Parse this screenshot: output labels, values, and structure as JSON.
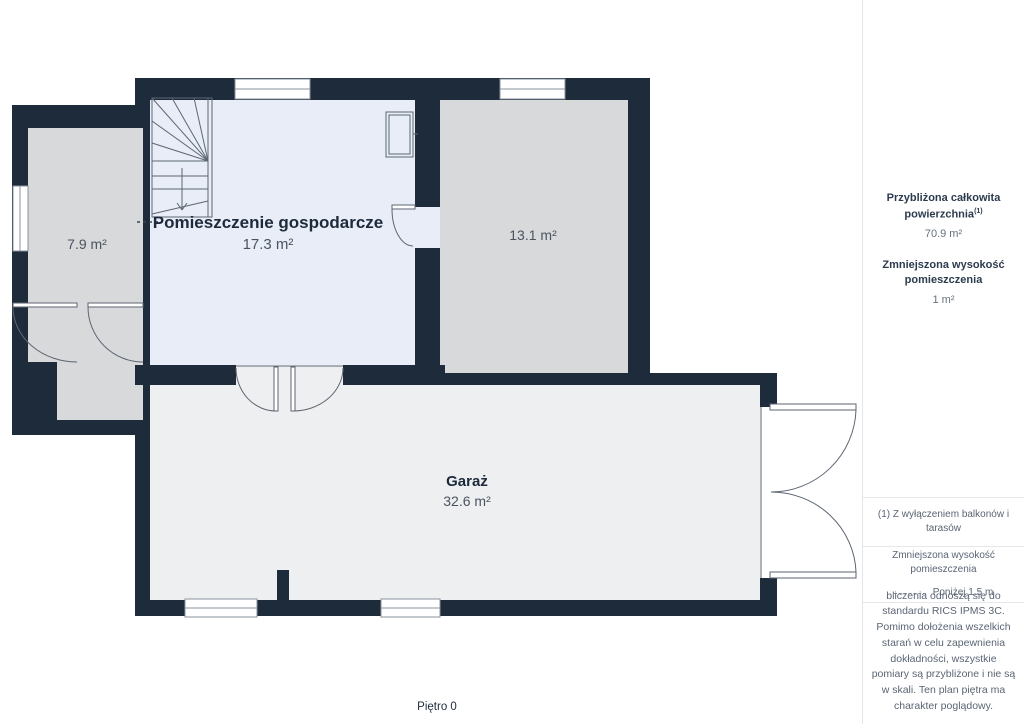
{
  "plan": {
    "rooms": {
      "utility": {
        "name": "Pomieszczenie gospodarcze",
        "area": "17.3 m²"
      },
      "room_13": {
        "area": "13.1 m²"
      },
      "room_79": {
        "area": "7.9 m²"
      },
      "garage": {
        "name": "Garaż",
        "area": "32.6 m²"
      }
    },
    "floor_label": "Piętro 0"
  },
  "sidebar": {
    "total_area_title": "Przybliżona całkowita powierzchnia",
    "total_area_footnote_marker": "(1)",
    "total_area_value": "70.9 m²",
    "reduced_height_title": "Zmniejszona wysokość pomieszczenia",
    "reduced_height_value": "1 m²",
    "footnote": "(1) Z wyłączeniem balkonów i tarasów",
    "legend_title": "Zmniejszona wysokość pomieszczenia",
    "legend_value": "Poniżej 1.5 m",
    "disclaimer": "bliczenia odnoszą się do standardu RICS IPMS 3C. Pomimo dołożenia wszelkich starań w celu zapewnienia dokładności, wszystkie pomiary są przybliżone i nie są w skali. Ten plan piętra ma charakter poglądowy.",
    "brand_name": "GIRAFFE",
    "brand_suffix": "360"
  },
  "colors": {
    "wall": "#1e2b3b",
    "room_utility_fill": "#e8edf7",
    "room_gray_fill": "#d8d9db",
    "garage_fill": "#eeeff0",
    "detail_line": "#5d6672",
    "title_text": "#1d2a3b",
    "muted_text": "#5b6575"
  }
}
